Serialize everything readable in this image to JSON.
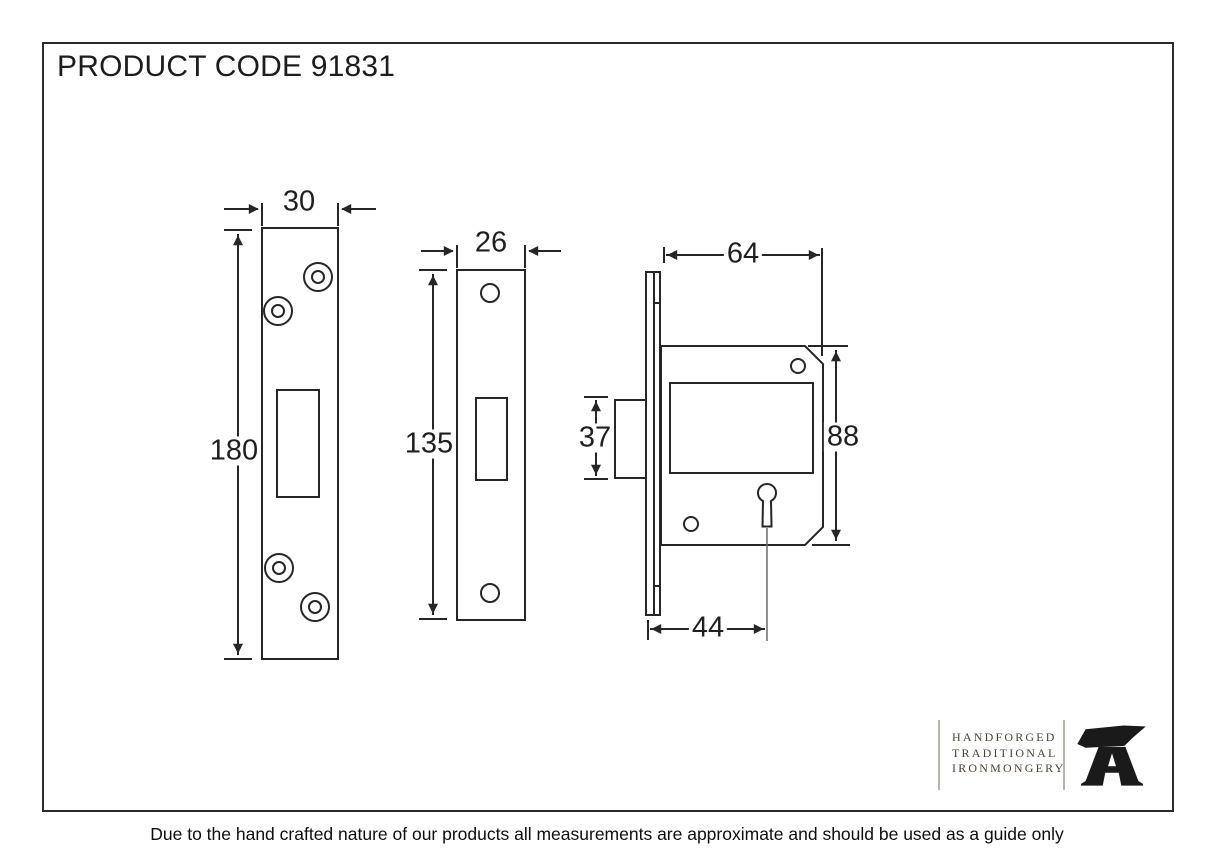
{
  "title": "PRODUCT CODE 91831",
  "product_code": "91831",
  "footer_note": "Due to the hand crafted nature of our products all measurements are approximate and should be used as a guide only",
  "brand": {
    "line1": "HANDFORGED",
    "line2": "TRADITIONAL",
    "line3": "IRONMONGERY",
    "icon": "anvil-icon"
  },
  "colors": {
    "drawing_line": "#262626",
    "brand_text": "#4b4437",
    "brand_rule": "#b8b3ab",
    "frame": "#2b2b2b"
  },
  "views": {
    "strike_plate": {
      "label": "strike-plate-front-view",
      "width_mm": "30",
      "height_mm": "180"
    },
    "faceplate": {
      "label": "faceplate-front-view",
      "width_mm": "26",
      "height_mm": "135"
    },
    "lock_case": {
      "label": "lock-case-side-view",
      "depth_mm": "64",
      "height_mm": "88",
      "bolt_height_mm": "37",
      "backset_mm": "44"
    }
  }
}
